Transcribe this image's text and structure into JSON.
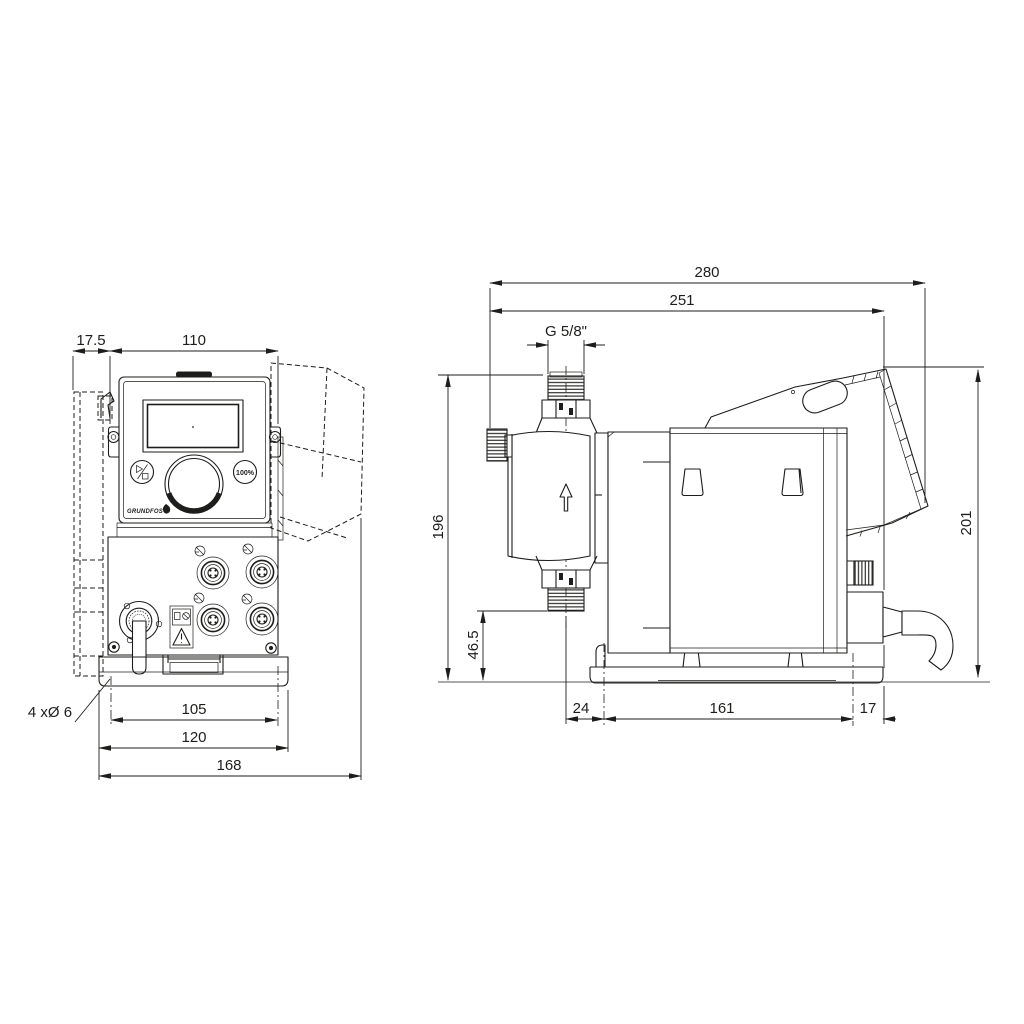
{
  "front_view": {
    "dims": {
      "offset": "17.5",
      "housing_width": "110",
      "hole_spacing": "105",
      "plate_width": "120",
      "overall_width": "168"
    },
    "labels": {
      "mounting_holes": "4 xØ 6"
    },
    "panel": {
      "percent_button": "100%",
      "brand": "GRUNDFOS"
    }
  },
  "side_view": {
    "dims": {
      "overall_depth": "280",
      "depth_to_cable_gland": "251",
      "thread": "G 5/8\"",
      "height_to_connection": "196",
      "connection_height": "46.5",
      "height_to_panel": "201",
      "center_to_hole": "24",
      "hole_spacing": "161",
      "hole_to_edge": "17"
    }
  }
}
